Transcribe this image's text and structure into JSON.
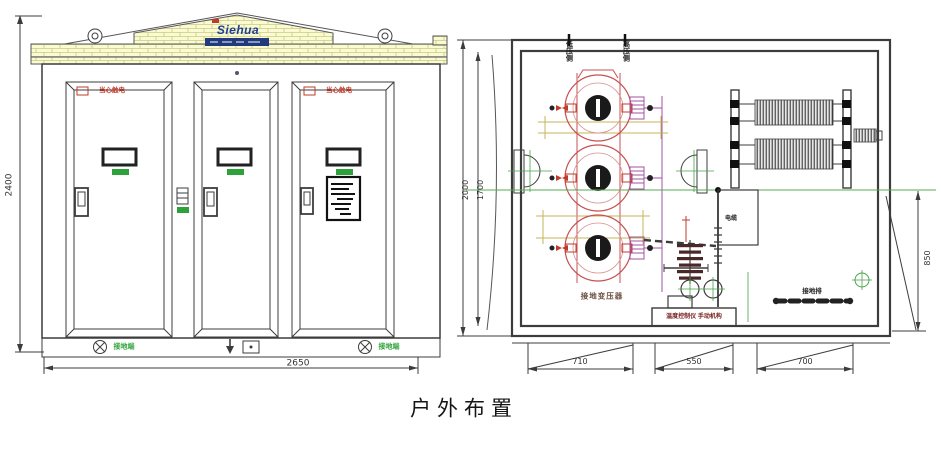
{
  "title": "户外布置",
  "front_view": {
    "dim_height": "2400",
    "dim_width": "2650",
    "logo_text": "Siehua",
    "doors": [
      {
        "warning": "当心触电"
      },
      {
        "warning": ""
      },
      {
        "warning": "当心触电"
      }
    ],
    "ground_label_left": "接地端",
    "ground_label_right": "接地端"
  },
  "plan_view": {
    "top_label_left": "低压侧",
    "top_label_right": "高压侧",
    "transformer_label": "接地变压器",
    "control_label": "温度控制仪 手动机构",
    "ground_bus_label": "接地排",
    "cable_label": "电缆",
    "dim_outer": "2000",
    "dim_inner": "1700",
    "dim_right": "850",
    "dim_bottom": [
      "710",
      "550",
      "700"
    ]
  },
  "colors": {
    "line": "#3c3c3c",
    "brick_fill": "#fbfbd2",
    "brick_line": "#c9c98a",
    "logo_blue": "#1d3e94",
    "warning_red": "#c23b2a",
    "green": "#2ea23a",
    "transformer_red": "#c85050",
    "winding_purple": "#a050a0",
    "centerline_green": "#55aa55",
    "guide_khaki": "#bfae4a"
  }
}
